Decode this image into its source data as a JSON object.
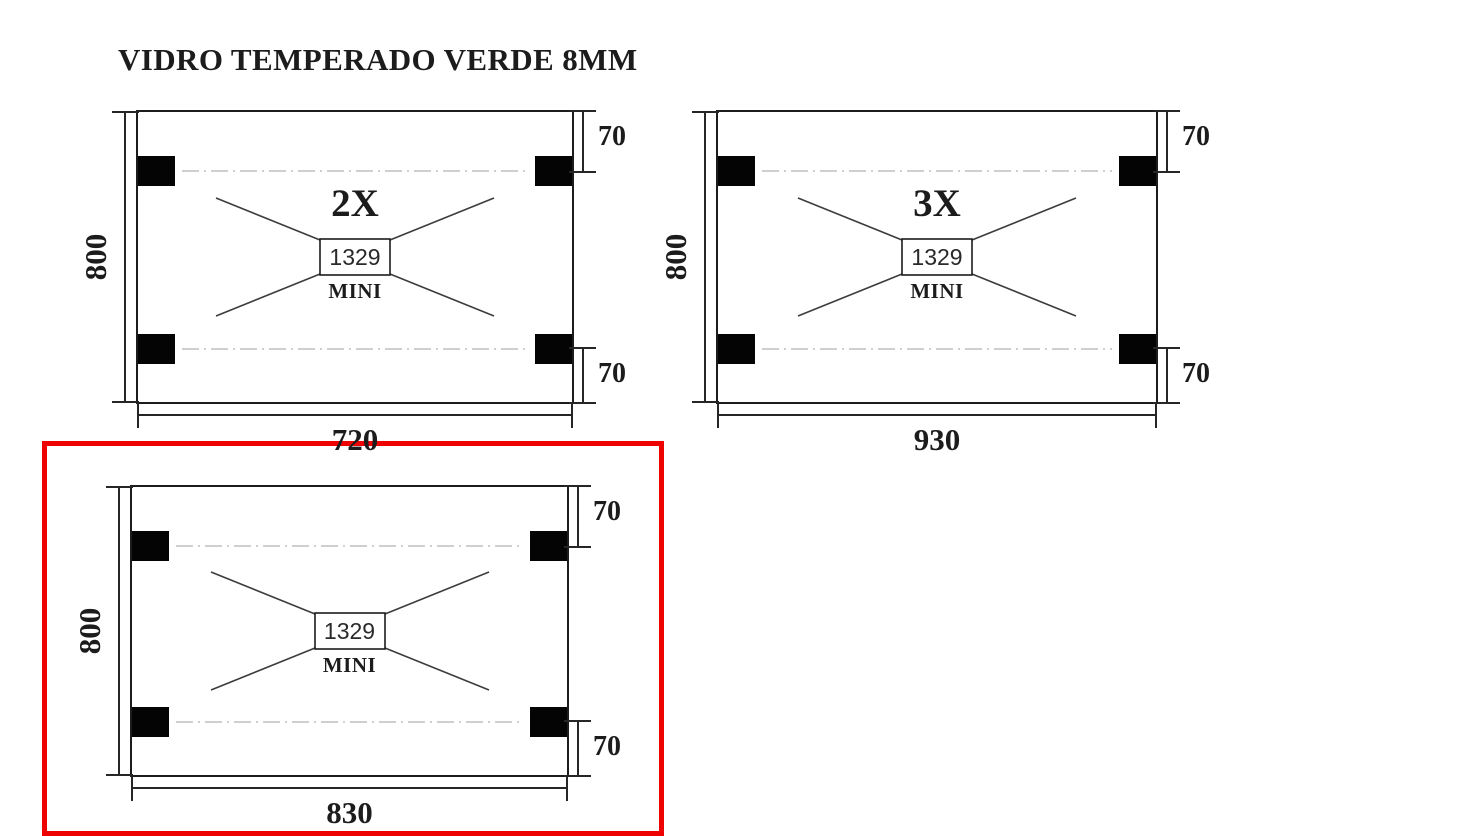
{
  "title": "VIDRO TEMPERADO VERDE 8MM",
  "colors": {
    "highlight_box": "#ee0202",
    "drawing_line": "#1c1c1c",
    "pad_fill": "#040404",
    "centerline": "#cfcfcf"
  },
  "panels": [
    {
      "name": "glass-panel-720x800",
      "quantity_label": "2X",
      "hardware_model": "1329",
      "hardware_series": "MINI",
      "width": "720",
      "height": "800",
      "hole_offset_top": "70",
      "hole_offset_bottom": "70",
      "highlighted": false
    },
    {
      "name": "glass-panel-930x800",
      "quantity_label": "3X",
      "hardware_model": "1329",
      "hardware_series": "MINI",
      "width": "930",
      "height": "800",
      "hole_offset_top": "70",
      "hole_offset_bottom": "70",
      "highlighted": false
    },
    {
      "name": "glass-panel-830x800",
      "quantity_label": "",
      "hardware_model": "1329",
      "hardware_series": "MINI",
      "width": "830",
      "height": "800",
      "hole_offset_top": "70",
      "hole_offset_bottom": "70",
      "highlighted": true
    }
  ]
}
